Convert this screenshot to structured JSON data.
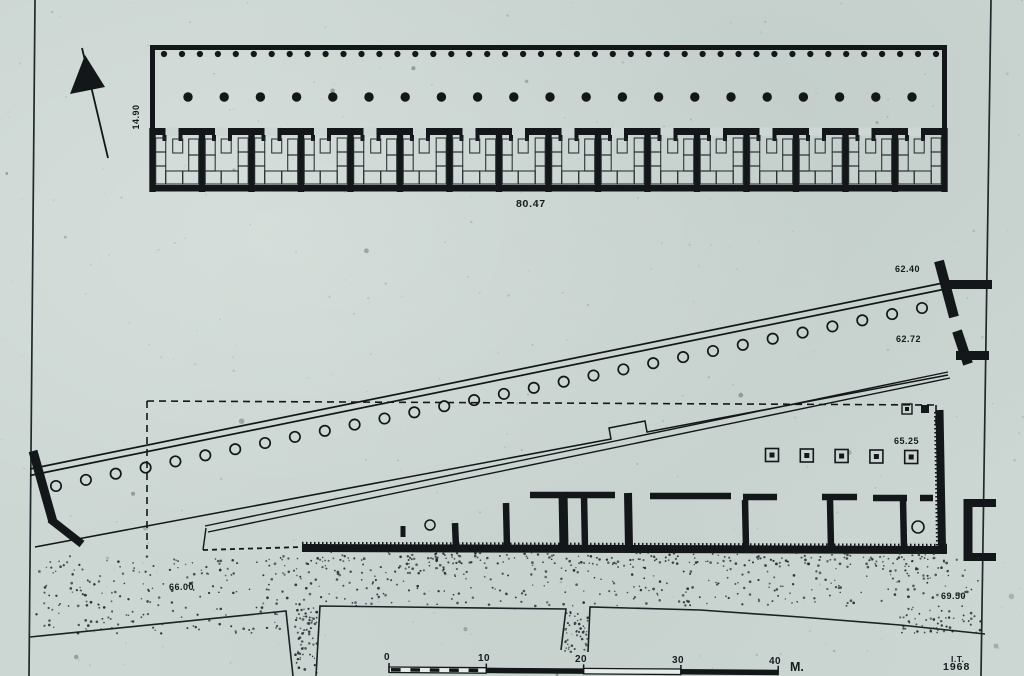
{
  "title": "Excavation site plan, scanned ink drawing",
  "labels": {
    "north_stoa_width": "14.90",
    "north_stoa_length": "80.47",
    "diagonal_stoa_upper": "62.40",
    "diagonal_stoa_lower": "62.72",
    "lower_building": "65.25",
    "ground_left": "66.00",
    "ground_right": "69.50"
  },
  "scale_bar": {
    "ticks": [
      "0",
      "10",
      "20",
      "30",
      "40"
    ],
    "unit": "M."
  },
  "credit": {
    "initials": "I.T.",
    "year": "1968"
  },
  "plan": {
    "north_stoa": {
      "front_column_count": 44,
      "inner_column_count": 21,
      "room_count": 16
    },
    "diagonal_stoa": {
      "column_count": 30
    },
    "lower_building": {
      "pier_base_count": 5,
      "room_stub_count": 8
    },
    "colors": {
      "paper": "#ccd6d2",
      "ink": "#14171a"
    }
  }
}
